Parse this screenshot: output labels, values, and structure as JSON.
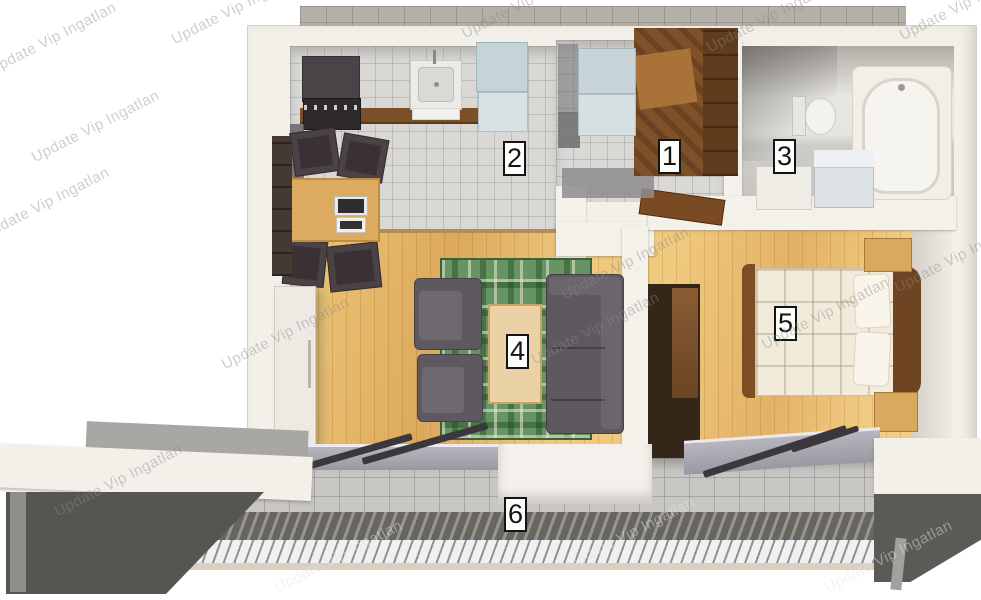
{
  "watermark": {
    "text": "Update Vip Ingatlan"
  },
  "rooms": [
    {
      "number": "1",
      "area": "entrance-hall"
    },
    {
      "number": "2",
      "area": "kitchen-hallway"
    },
    {
      "number": "3",
      "area": "bathroom"
    },
    {
      "number": "4",
      "area": "living-room"
    },
    {
      "number": "5",
      "area": "bedroom"
    },
    {
      "number": "6",
      "area": "terrace"
    }
  ],
  "palette": {
    "wall": "#f3f0e9",
    "interior_tile": "#d9d8d5",
    "exterior_tile": "#b4b0a8",
    "wood_floor": "#e4b568",
    "rug_green": "#679463",
    "sofa_gray": "#5e5860",
    "furniture_wood": "#7e5128",
    "terrace_tile": "#c9c7c3",
    "deck_dark": "#67655f",
    "label_border": "#141414"
  }
}
